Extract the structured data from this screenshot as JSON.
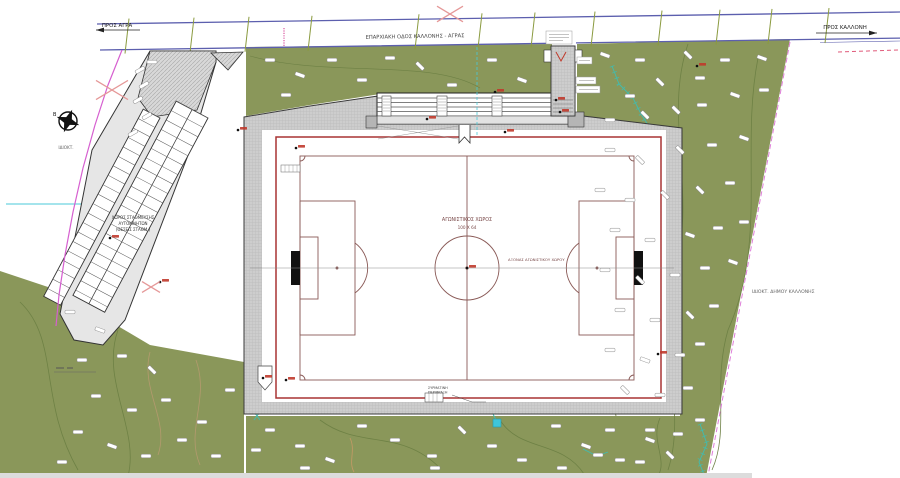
{
  "road": {
    "name": "ΕΠΑΡΧΙΑΚΗ ΟΔΟΣ ΚΑΛΛΟΝΗΣ - ΑΓΡΑΣ",
    "dir_left": "ΠΡΟΣ ΑΓΡΑ",
    "dir_right": "ΠΡΟΣ ΚΑΛΛΟΝΗ"
  },
  "pitch": {
    "title": "ΑΓΩΝΙΣΤΙΚΟΣ ΧΩΡΟΣ",
    "dimensions": "100 Χ 64",
    "axis_label": "ΑΞΟΝΑΣ ΑΓΩΝΙΣΤΙΚΟΥ ΧΩΡΟΥ"
  },
  "parking": {
    "label_line1": "ΧΩΡΟΣ ΣΤΑΘΜΕΥΣΗΣ",
    "label_line2": "ΑΥΤΟΚΙΝΗΤΩΝ",
    "label_line3": "(ΘΕΣΕΙΣ ΣΤΑΘΜ.)"
  },
  "ownership": {
    "right": "ΙΔΙΟΚΤ. ΔΗΜΟΥ ΚΑΛΛΟΝΗΣ",
    "left": "ΙΔΙΟΚΤ."
  },
  "compass": {
    "north": "Β"
  },
  "fence_note": {
    "line1": "ΣΥΡΜΑΤΙΝΗ",
    "line2": "ΠΕΡΙΦΡΑΞΗ"
  },
  "colors": {
    "vegetation": "#8a975a",
    "contour": "#6e8145",
    "road_edge": "#5c5fae",
    "fence_red": "#a83333",
    "field_marking": "#8a5a57",
    "boundary_magenta": "#d65fd0",
    "stream_teal": "#3fbdb2",
    "utility_cyan": "#49c9d8",
    "marker_red": "#c0392b",
    "cross_red": "#e59898",
    "walkway_gray": "#cdcdcd"
  },
  "vegetation_marks": [
    [
      605,
      55,
      20
    ],
    [
      640,
      60,
      0
    ],
    [
      688,
      55,
      45
    ],
    [
      725,
      60,
      0
    ],
    [
      762,
      58,
      20
    ],
    [
      700,
      78,
      0
    ],
    [
      660,
      82,
      45
    ],
    [
      630,
      96,
      0
    ],
    [
      610,
      120,
      0
    ],
    [
      645,
      115,
      45
    ],
    [
      676,
      110,
      45
    ],
    [
      702,
      105,
      0
    ],
    [
      735,
      95,
      20
    ],
    [
      764,
      90,
      0
    ],
    [
      610,
      150,
      0
    ],
    [
      640,
      160,
      45
    ],
    [
      680,
      150,
      45
    ],
    [
      712,
      145,
      0
    ],
    [
      744,
      138,
      20
    ],
    [
      600,
      190,
      0
    ],
    [
      630,
      200,
      0
    ],
    [
      665,
      195,
      45
    ],
    [
      700,
      190,
      45
    ],
    [
      730,
      183,
      0
    ],
    [
      615,
      230,
      0
    ],
    [
      650,
      240,
      0
    ],
    [
      690,
      235,
      20
    ],
    [
      718,
      228,
      0
    ],
    [
      744,
      222,
      0
    ],
    [
      605,
      270,
      0
    ],
    [
      640,
      280,
      45
    ],
    [
      675,
      275,
      0
    ],
    [
      705,
      268,
      0
    ],
    [
      733,
      262,
      20
    ],
    [
      620,
      310,
      0
    ],
    [
      655,
      320,
      0
    ],
    [
      690,
      315,
      45
    ],
    [
      714,
      306,
      0
    ],
    [
      610,
      350,
      0
    ],
    [
      645,
      360,
      20
    ],
    [
      680,
      355,
      0
    ],
    [
      700,
      344,
      0
    ],
    [
      625,
      390,
      45
    ],
    [
      660,
      395,
      0
    ],
    [
      688,
      388,
      0
    ],
    [
      610,
      430,
      0
    ],
    [
      650,
      440,
      20
    ],
    [
      678,
      434,
      0
    ],
    [
      598,
      455,
      0
    ],
    [
      640,
      462,
      0
    ],
    [
      670,
      455,
      45
    ],
    [
      700,
      420,
      0
    ],
    [
      270,
      60,
      0
    ],
    [
      300,
      75,
      20
    ],
    [
      332,
      60,
      0
    ],
    [
      362,
      80,
      0
    ],
    [
      420,
      66,
      45
    ],
    [
      452,
      85,
      0
    ],
    [
      492,
      60,
      0
    ],
    [
      522,
      80,
      20
    ],
    [
      286,
      95,
      0
    ],
    [
      390,
      58,
      0
    ],
    [
      270,
      430,
      0
    ],
    [
      300,
      446,
      0
    ],
    [
      330,
      460,
      20
    ],
    [
      362,
      426,
      0
    ],
    [
      395,
      440,
      0
    ],
    [
      432,
      456,
      0
    ],
    [
      462,
      430,
      45
    ],
    [
      492,
      446,
      0
    ],
    [
      522,
      460,
      0
    ],
    [
      556,
      426,
      0
    ],
    [
      586,
      446,
      20
    ],
    [
      620,
      460,
      0
    ],
    [
      650,
      430,
      0
    ],
    [
      305,
      468,
      0
    ],
    [
      435,
      468,
      0
    ],
    [
      562,
      468,
      0
    ],
    [
      256,
      450,
      0
    ],
    [
      70,
      312,
      0
    ],
    [
      100,
      330,
      20
    ],
    [
      82,
      360,
      0
    ],
    [
      122,
      356,
      0
    ],
    [
      152,
      370,
      45
    ],
    [
      96,
      396,
      0
    ],
    [
      132,
      410,
      0
    ],
    [
      166,
      400,
      0
    ],
    [
      78,
      432,
      0
    ],
    [
      112,
      446,
      20
    ],
    [
      146,
      456,
      0
    ],
    [
      182,
      440,
      0
    ],
    [
      202,
      422,
      0
    ],
    [
      216,
      456,
      0
    ],
    [
      62,
      462,
      0
    ],
    [
      230,
      390,
      0
    ],
    [
      140,
      70,
      -30
    ],
    [
      144,
      85,
      -30
    ],
    [
      138,
      100,
      -30
    ],
    [
      147,
      116,
      -30
    ],
    [
      133,
      133,
      -30
    ],
    [
      152,
      62,
      0
    ]
  ],
  "spot_markers": [
    [
      238,
      130
    ],
    [
      296,
      148
    ],
    [
      427,
      119
    ],
    [
      505,
      132
    ],
    [
      467,
      268
    ],
    [
      560,
      112
    ],
    [
      658,
      354
    ],
    [
      263,
      378
    ],
    [
      286,
      380
    ],
    [
      110,
      238
    ],
    [
      160,
      282
    ],
    [
      697,
      66
    ],
    [
      556,
      100
    ],
    [
      495,
      92
    ]
  ],
  "road_ticks": [
    127,
    192,
    247,
    310,
    417,
    480,
    533,
    593,
    660,
    718,
    770,
    827
  ],
  "red_crosses": [
    [
      450,
      14,
      13
    ],
    [
      112,
      90,
      16
    ],
    [
      151,
      287,
      9
    ]
  ]
}
